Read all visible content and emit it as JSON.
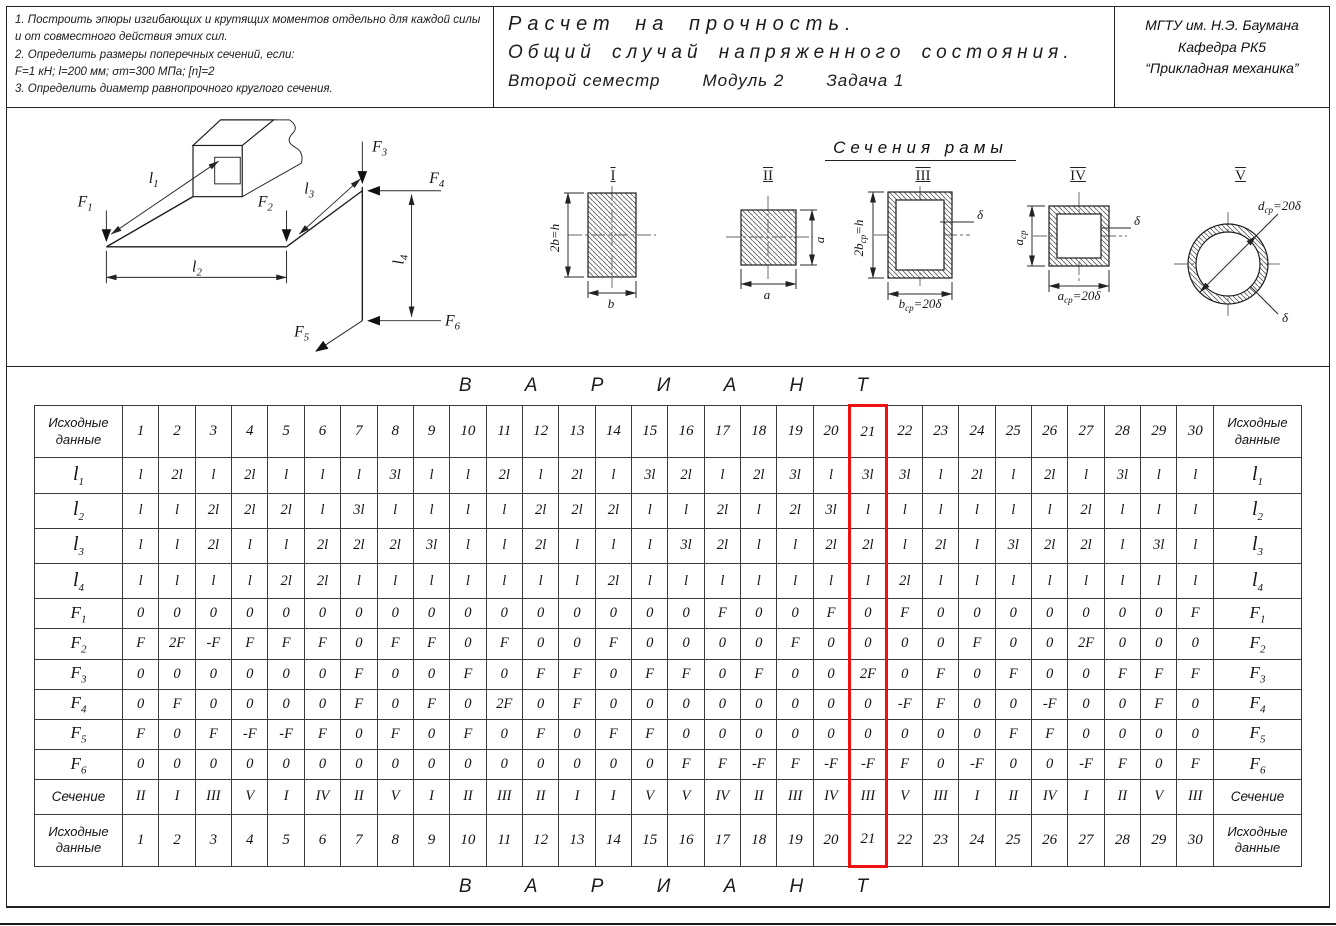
{
  "header": {
    "tasks": [
      "1.  Построить эпюры изгибающих и крутящих моментов отдельно для каждой силы и от совместного действия этих сил.",
      "2.  Определить размеры поперечных сечений,  если:",
      "F=1 кН;  l=200 мм;  σт=300 МПа;  [n]=2",
      "3.  Определить диаметр равнопрочного круглого сечения."
    ],
    "title_line1": "Расчет на прочность.",
    "title_line2": "Общий случай напряженного состояния.",
    "title_line3a": "Второй семестр",
    "title_line3b": "Модуль 2",
    "title_line3c": "Задача 1",
    "institution_line1": "МГТУ им. Н.Э. Баумана",
    "institution_line2": "Кафедра РК5",
    "institution_line3": "“Прикладная механика”"
  },
  "diagram": {
    "forces": [
      {
        "main": "F",
        "sub": "1"
      },
      {
        "main": "F",
        "sub": "2"
      },
      {
        "main": "F",
        "sub": "3"
      },
      {
        "main": "F",
        "sub": "4"
      },
      {
        "main": "F",
        "sub": "5"
      },
      {
        "main": "F",
        "sub": "6"
      }
    ],
    "lengths": [
      {
        "main": "l",
        "sub": "1"
      },
      {
        "main": "l",
        "sub": "2"
      },
      {
        "main": "l",
        "sub": "3"
      },
      {
        "main": "l",
        "sub": "4"
      }
    ]
  },
  "sections": {
    "title": "Сечения рамы",
    "figures": [
      {
        "numeral": "I",
        "bottom": {
          "pre": "b",
          "sub": "",
          "post": ""
        },
        "side": {
          "pre": "2b",
          "sub": "",
          "post": "=h"
        }
      },
      {
        "numeral": "II",
        "bottom": {
          "pre": "a",
          "sub": "",
          "post": ""
        },
        "side": {
          "pre": "a",
          "sub": "",
          "post": ""
        }
      },
      {
        "numeral": "III",
        "bottom": {
          "pre": "b",
          "sub": "ср",
          "post": "=20δ"
        },
        "side": {
          "pre": "2b",
          "sub": "ср",
          "post": "=h"
        },
        "thickness": "δ"
      },
      {
        "numeral": "IV",
        "bottom": {
          "pre": "a",
          "sub": "ср",
          "post": "=20δ"
        },
        "side": {
          "pre": "a",
          "sub": "ср",
          "post": ""
        },
        "thickness": "δ"
      },
      {
        "numeral": "V",
        "diameter": {
          "pre": "d",
          "sub": "ср",
          "post": "=20δ"
        },
        "thickness": "δ"
      }
    ]
  },
  "table": {
    "variant_word": "В А Р И А Н Т",
    "corner_label": "Исходные данные",
    "highlight_column": 21,
    "variant_numbers": [
      "1",
      "2",
      "3",
      "4",
      "5",
      "6",
      "7",
      "8",
      "9",
      "10",
      "11",
      "12",
      "13",
      "14",
      "15",
      "16",
      "17",
      "18",
      "19",
      "20",
      "21",
      "22",
      "23",
      "24",
      "25",
      "26",
      "27",
      "28",
      "29",
      "30"
    ],
    "rows": [
      {
        "label": {
          "main": "l",
          "sub": "1"
        },
        "values": [
          "l",
          "2l",
          "l",
          "2l",
          "l",
          "l",
          "l",
          "3l",
          "l",
          "l",
          "2l",
          "l",
          "2l",
          "l",
          "3l",
          "2l",
          "l",
          "2l",
          "3l",
          "l",
          "3l",
          "3l",
          "l",
          "2l",
          "l",
          "2l",
          "l",
          "3l",
          "l",
          "l"
        ]
      },
      {
        "label": {
          "main": "l",
          "sub": "2"
        },
        "values": [
          "l",
          "l",
          "2l",
          "2l",
          "2l",
          "l",
          "3l",
          "l",
          "l",
          "l",
          "l",
          "2l",
          "2l",
          "2l",
          "l",
          "l",
          "2l",
          "l",
          "2l",
          "3l",
          "l",
          "l",
          "l",
          "l",
          "l",
          "l",
          "2l",
          "l",
          "l",
          "l"
        ]
      },
      {
        "label": {
          "main": "l",
          "sub": "3"
        },
        "values": [
          "l",
          "l",
          "2l",
          "l",
          "l",
          "2l",
          "2l",
          "2l",
          "3l",
          "l",
          "l",
          "2l",
          "l",
          "l",
          "l",
          "3l",
          "2l",
          "l",
          "l",
          "2l",
          "2l",
          "l",
          "2l",
          "l",
          "3l",
          "2l",
          "2l",
          "l",
          "3l",
          "l"
        ]
      },
      {
        "label": {
          "main": "l",
          "sub": "4"
        },
        "values": [
          "l",
          "l",
          "l",
          "l",
          "2l",
          "2l",
          "l",
          "l",
          "l",
          "l",
          "l",
          "l",
          "l",
          "2l",
          "l",
          "l",
          "l",
          "l",
          "l",
          "l",
          "l",
          "2l",
          "l",
          "l",
          "l",
          "l",
          "l",
          "l",
          "l",
          "l"
        ]
      },
      {
        "label": {
          "main": "F",
          "sub": "1"
        },
        "values": [
          "0",
          "0",
          "0",
          "0",
          "0",
          "0",
          "0",
          "0",
          "0",
          "0",
          "0",
          "0",
          "0",
          "0",
          "0",
          "0",
          "F",
          "0",
          "0",
          "F",
          "0",
          "F",
          "0",
          "0",
          "0",
          "0",
          "0",
          "0",
          "0",
          "F"
        ]
      },
      {
        "label": {
          "main": "F",
          "sub": "2"
        },
        "values": [
          "F",
          "2F",
          "-F",
          "F",
          "F",
          "F",
          "0",
          "F",
          "F",
          "0",
          "F",
          "0",
          "0",
          "F",
          "0",
          "0",
          "0",
          "0",
          "F",
          "0",
          "0",
          "0",
          "0",
          "F",
          "0",
          "0",
          "2F",
          "0",
          "0",
          "0"
        ]
      },
      {
        "label": {
          "main": "F",
          "sub": "3"
        },
        "values": [
          "0",
          "0",
          "0",
          "0",
          "0",
          "0",
          "F",
          "0",
          "0",
          "F",
          "0",
          "F",
          "F",
          "0",
          "F",
          "F",
          "0",
          "F",
          "0",
          "0",
          "2F",
          "0",
          "F",
          "0",
          "F",
          "0",
          "0",
          "F",
          "F",
          "F"
        ]
      },
      {
        "label": {
          "main": "F",
          "sub": "4"
        },
        "values": [
          "0",
          "F",
          "0",
          "0",
          "0",
          "0",
          "F",
          "0",
          "F",
          "0",
          "2F",
          "0",
          "F",
          "0",
          "0",
          "0",
          "0",
          "0",
          "0",
          "0",
          "0",
          "-F",
          "F",
          "0",
          "0",
          "-F",
          "0",
          "0",
          "F",
          "0"
        ]
      },
      {
        "label": {
          "main": "F",
          "sub": "5"
        },
        "values": [
          "F",
          "0",
          "F",
          "-F",
          "-F",
          "F",
          "0",
          "F",
          "0",
          "F",
          "0",
          "F",
          "0",
          "F",
          "F",
          "0",
          "0",
          "0",
          "0",
          "0",
          "0",
          "0",
          "0",
          "0",
          "F",
          "F",
          "0",
          "0",
          "0",
          "0"
        ]
      },
      {
        "label": {
          "main": "F",
          "sub": "6"
        },
        "values": [
          "0",
          "0",
          "0",
          "0",
          "0",
          "0",
          "0",
          "0",
          "0",
          "0",
          "0",
          "0",
          "0",
          "0",
          "0",
          "F",
          "F",
          "-F",
          "F",
          "-F",
          "-F",
          "F",
          "0",
          "-F",
          "0",
          "0",
          "-F",
          "F",
          "0",
          "F"
        ]
      },
      {
        "label": {
          "main": "Сечение",
          "sub": ""
        },
        "values": [
          "II",
          "I",
          "III",
          "V",
          "I",
          "IV",
          "II",
          "V",
          "I",
          "II",
          "III",
          "II",
          "I",
          "I",
          "V",
          "V",
          "IV",
          "II",
          "III",
          "IV",
          "III",
          "V",
          "III",
          "I",
          "II",
          "IV",
          "I",
          "II",
          "V",
          "III"
        ]
      }
    ]
  }
}
